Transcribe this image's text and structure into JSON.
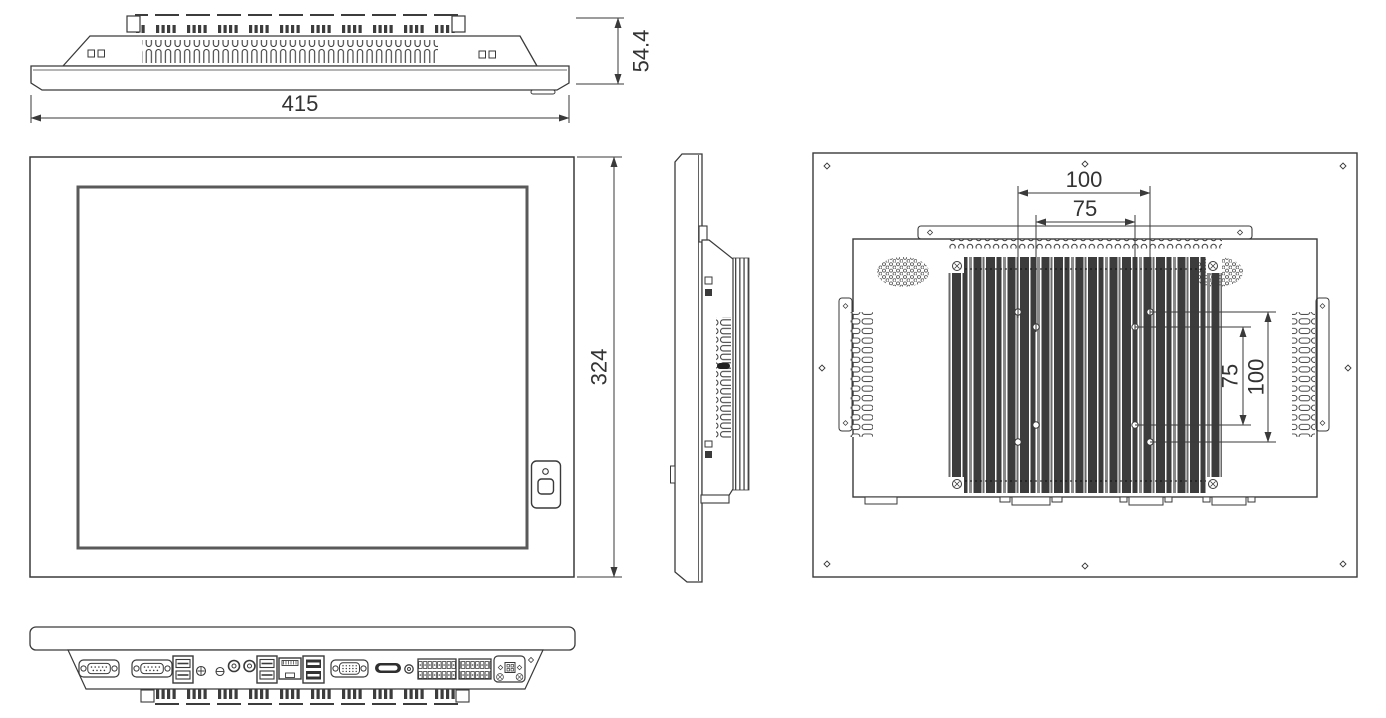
{
  "page": {
    "background_color": "#ffffff",
    "line_color": "#3a3a3a",
    "fin_color": "#3c3c3c"
  },
  "dimensions": {
    "top_depth": "54.4",
    "front_width": "415",
    "front_height": "324",
    "vesa_top_outer": "100",
    "vesa_top_inner": "75",
    "vesa_right_inner": "75",
    "vesa_right_outer": "100"
  }
}
